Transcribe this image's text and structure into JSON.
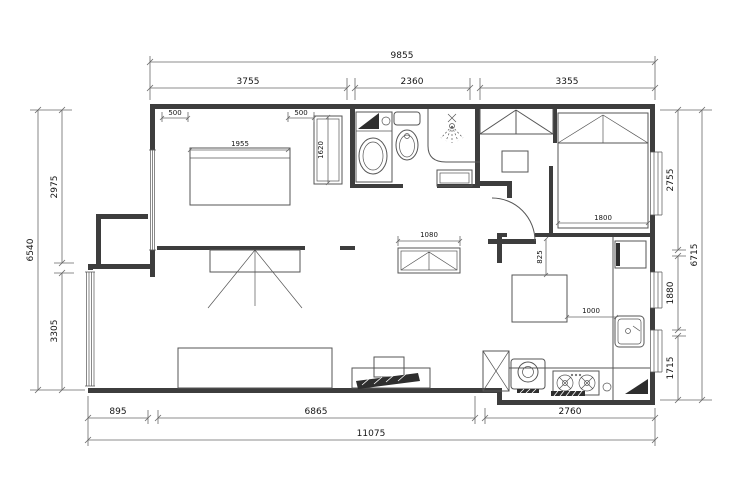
{
  "drawing": {
    "type": "apartment-floor-plan",
    "colors": {
      "background": "#ffffff",
      "wall": "#3d3d3d",
      "furniture_line": "#565656",
      "dimension_line": "#6a6a6a",
      "text": "#141414",
      "solid_fill": "#2e2e2e"
    }
  },
  "dimensions": {
    "top_total": "9855",
    "top_segments": [
      "3755",
      "2360",
      "3355"
    ],
    "left_total": "6540",
    "left_segments": [
      "2975",
      "3305"
    ],
    "right_total": "6715",
    "right_segments": [
      "2755",
      "1880",
      "1715"
    ],
    "bottom_total": "11075",
    "bottom_segments": [
      "895",
      "6865",
      "2760"
    ],
    "bed1_left_offset": "500",
    "bed1_width": "1955",
    "bed1_right_offset": "500",
    "wardrobe_length": "1620",
    "bed2_width": "1800",
    "console_width": "1080",
    "kitchen_clearance": "825",
    "worktop_width": "1000"
  },
  "fixture_icons": [
    "double-bed",
    "wardrobe-hanging",
    "washing-machine",
    "toilet",
    "shower-head",
    "shower-tray",
    "entry-closet",
    "single-bed",
    "kitchen-table",
    "kitchen-sink",
    "fridge",
    "gas-stove",
    "duct-shaft",
    "sofa",
    "tv-panel",
    "tv-cabinet",
    "shoe-console",
    "door-swing",
    "window",
    "bay-window"
  ]
}
